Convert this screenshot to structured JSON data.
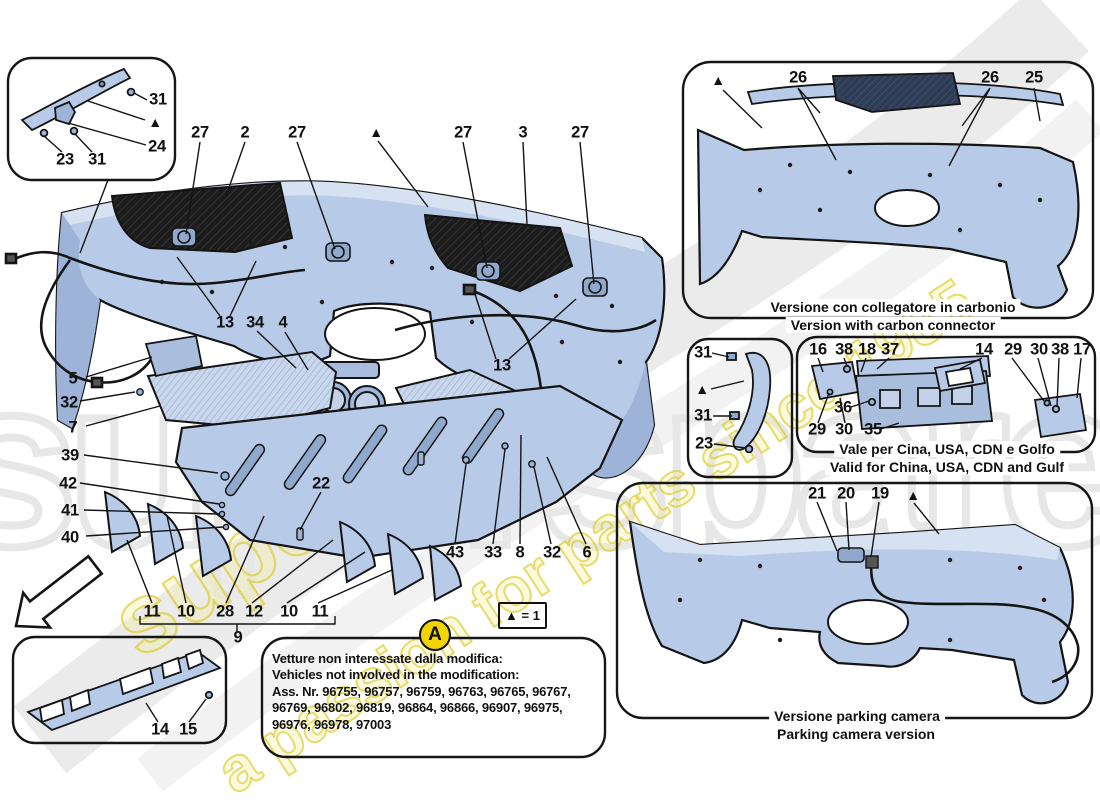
{
  "watermark": {
    "brand_text": "superspares",
    "tagline_text": "a passion for parts since 1985",
    "giant_text": "superspares",
    "yellow": "#e6d62e",
    "gray": "#e8e8e8"
  },
  "colors": {
    "part_fill": "#b7cae7",
    "part_shade": "#93abd1",
    "outline": "#141414",
    "mesh_dark": "#1c1c1c",
    "note_marker_bg": "#f2d400"
  },
  "legend": {
    "text": "▲ = 1"
  },
  "note_box": {
    "marker": "A",
    "line1": "Vetture non interessate dalla modifica:",
    "line2": "Vehicles not involved in the modification:",
    "line3": "Ass. Nr. 96755, 96757, 96759, 96763, 96765, 96767,",
    "line4": "96769, 96802, 96819, 96864, 96866, 96907, 96975,",
    "line5": "96976, 96978, 97003"
  },
  "captions": {
    "carbon_it": "Versione con collegatore in carbonio",
    "carbon_en": "Version with carbon connector",
    "gulf_it": "Vale per Cina, USA, CDN e Golfo",
    "gulf_en": "Valid for China, USA, CDN and Gulf",
    "parking_it": "Versione parking camera",
    "parking_en": "Parking camera version"
  },
  "callouts": [
    {
      "t": "27",
      "x": 200,
      "y": 133
    },
    {
      "t": "2",
      "x": 245,
      "y": 133
    },
    {
      "t": "27",
      "x": 297,
      "y": 133
    },
    {
      "t": "▲",
      "x": 376,
      "y": 132
    },
    {
      "t": "27",
      "x": 463,
      "y": 133
    },
    {
      "t": "3",
      "x": 523,
      "y": 133
    },
    {
      "t": "27",
      "x": 580,
      "y": 133
    },
    {
      "t": "13",
      "x": 225,
      "y": 323
    },
    {
      "t": "34",
      "x": 255,
      "y": 323
    },
    {
      "t": "4",
      "x": 283,
      "y": 323
    },
    {
      "t": "13",
      "x": 502,
      "y": 366
    },
    {
      "t": "5",
      "x": 73,
      "y": 379
    },
    {
      "t": "32",
      "x": 69,
      "y": 403
    },
    {
      "t": "7",
      "x": 73,
      "y": 428
    },
    {
      "t": "39",
      "x": 70,
      "y": 456
    },
    {
      "t": "42",
      "x": 68,
      "y": 484
    },
    {
      "t": "41",
      "x": 70,
      "y": 511
    },
    {
      "t": "40",
      "x": 70,
      "y": 538
    },
    {
      "t": "22",
      "x": 321,
      "y": 484
    },
    {
      "t": "43",
      "x": 455,
      "y": 553
    },
    {
      "t": "33",
      "x": 493,
      "y": 553
    },
    {
      "t": "8",
      "x": 520,
      "y": 553
    },
    {
      "t": "32",
      "x": 552,
      "y": 553
    },
    {
      "t": "6",
      "x": 587,
      "y": 553
    },
    {
      "t": "11",
      "x": 152,
      "y": 612
    },
    {
      "t": "10",
      "x": 186,
      "y": 612
    },
    {
      "t": "28",
      "x": 225,
      "y": 612
    },
    {
      "t": "12",
      "x": 254,
      "y": 612
    },
    {
      "t": "10",
      "x": 289,
      "y": 612
    },
    {
      "t": "11",
      "x": 320,
      "y": 612
    },
    {
      "t": "9",
      "x": 238,
      "y": 638
    },
    {
      "t": "14",
      "x": 160,
      "y": 730
    },
    {
      "t": "15",
      "x": 188,
      "y": 730
    },
    {
      "t": "23",
      "x": 65,
      "y": 160
    },
    {
      "t": "31",
      "x": 97,
      "y": 160
    },
    {
      "t": "31",
      "x": 158,
      "y": 100
    },
    {
      "t": "▲",
      "x": 155,
      "y": 122
    },
    {
      "t": "24",
      "x": 157,
      "y": 147
    },
    {
      "t": "▲",
      "x": 718,
      "y": 80
    },
    {
      "t": "26",
      "x": 798,
      "y": 78
    },
    {
      "t": "26",
      "x": 990,
      "y": 78
    },
    {
      "t": "25",
      "x": 1034,
      "y": 78
    },
    {
      "t": "31",
      "x": 703,
      "y": 353
    },
    {
      "t": "▲",
      "x": 702,
      "y": 389
    },
    {
      "t": "31",
      "x": 703,
      "y": 416
    },
    {
      "t": "23",
      "x": 704,
      "y": 444
    },
    {
      "t": "16",
      "x": 818,
      "y": 350
    },
    {
      "t": "38",
      "x": 844,
      "y": 350
    },
    {
      "t": "18",
      "x": 867,
      "y": 350
    },
    {
      "t": "37",
      "x": 890,
      "y": 350
    },
    {
      "t": "14",
      "x": 984,
      "y": 350
    },
    {
      "t": "29",
      "x": 1013,
      "y": 350
    },
    {
      "t": "30",
      "x": 1039,
      "y": 350
    },
    {
      "t": "38",
      "x": 1060,
      "y": 350
    },
    {
      "t": "17",
      "x": 1082,
      "y": 350
    },
    {
      "t": "36",
      "x": 843,
      "y": 408
    },
    {
      "t": "29",
      "x": 817,
      "y": 430
    },
    {
      "t": "30",
      "x": 844,
      "y": 430
    },
    {
      "t": "35",
      "x": 873,
      "y": 430
    },
    {
      "t": "21",
      "x": 817,
      "y": 494
    },
    {
      "t": "20",
      "x": 846,
      "y": 494
    },
    {
      "t": "19",
      "x": 880,
      "y": 494
    },
    {
      "t": "▲",
      "x": 913,
      "y": 495
    }
  ]
}
